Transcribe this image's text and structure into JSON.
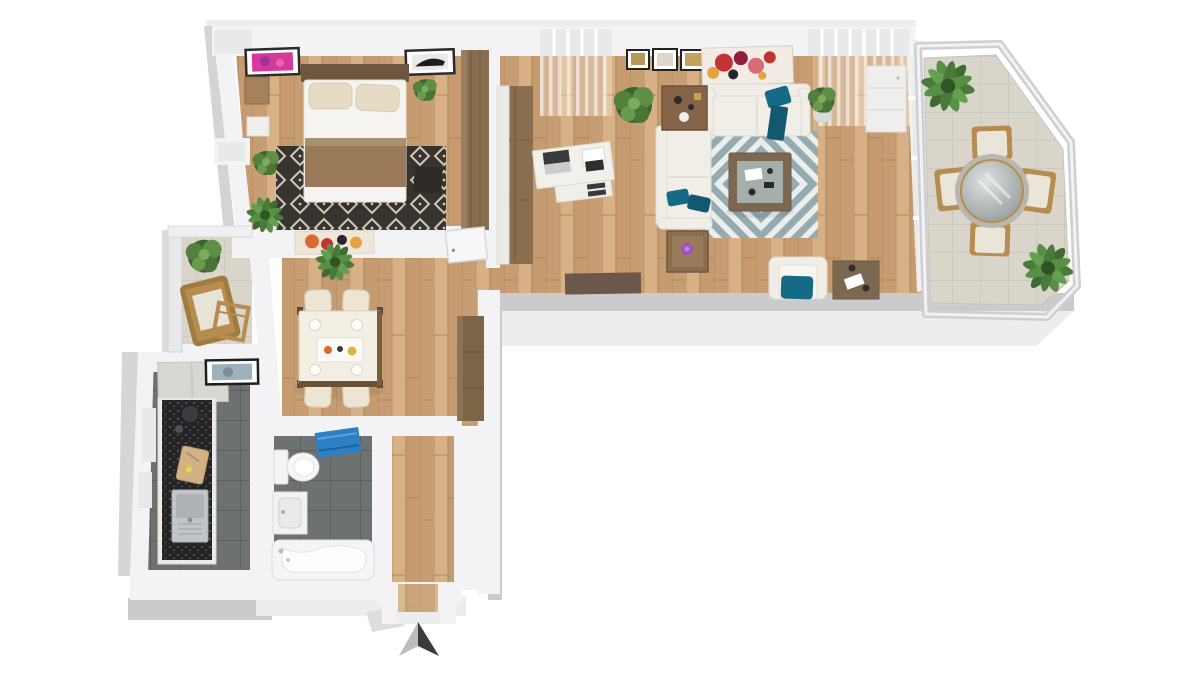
{
  "meta": {
    "description": "3D top-down rendered floor plan of an apartment with bedroom, living room, dining room, kitchen, bathroom, hallway and two balconies, north arrow at bottom",
    "view": "isometric top-down 3d render",
    "background": "white"
  },
  "colors": {
    "bg": "#ffffff",
    "wall_white": "#f3f3f5",
    "wall_shade": "#e7e7e9",
    "slab_gray": "#cbcbcd",
    "slab_light": "#ededef",
    "glass": "#e7e9eb",
    "wood_floor": "#cfa87e",
    "tile_dark": "#6d7170",
    "balcony_tile": "#d9d5cb",
    "rug_dark": "#37332f",
    "rug_cream": "#cfc8b8",
    "chevron_teal": "#93abb1",
    "chevron_white": "#eceeec",
    "accent_teal": "#156a85",
    "sofa_white": "#f1eee7",
    "wood_furniture": "#8a6e50",
    "chair_tan": "#b68d4f",
    "blanket_brown": "#9b7a5a",
    "pillow_beige": "#e6dcc6",
    "plant_green": "#53803e",
    "counter_black": "#242427",
    "towel_blue": "#2f7fc4",
    "flower_purple": "#a44fc0",
    "art_red": "#c13433",
    "art_pink": "#d6399b",
    "arrow_light": "#bdbdbf",
    "arrow_dark": "#3a3a3c"
  },
  "compass": {
    "direction": "north",
    "style": "two-tone arrow pointing up"
  },
  "rooms": [
    {
      "id": "bedroom",
      "floor": "wood",
      "furniture": [
        "double-bed",
        "dark-diamond-rug",
        "headboard",
        "nightstand",
        "white-cabinet",
        "wardrobe",
        "bench",
        "potted-plants",
        "pink-wall-art",
        "dark-wall-art",
        "window"
      ]
    },
    {
      "id": "living-room",
      "floor": "wood",
      "furniture": [
        "corner-sofa",
        "wall-sofa",
        "chevron-rug",
        "coffee-table",
        "side-table",
        "flower-table",
        "desk",
        "laptop",
        "drawer-unit",
        "armchair",
        "square-table",
        "door-mat",
        "tall-cabinet",
        "white-cabinet",
        "potted-plants",
        "three-small-frames",
        "abstract-painting",
        "windows",
        "glazed-balcony-wall"
      ]
    },
    {
      "id": "dining-room",
      "floor": "wood",
      "furniture": [
        "dining-table",
        "four-chairs",
        "table-runner",
        "plates",
        "sideboard",
        "potted-plant",
        "abstract-wall-art",
        "open-door"
      ]
    },
    {
      "id": "kitchen",
      "floor": "dark-tile",
      "furniture": [
        "l-counter",
        "granite-worktop",
        "sink",
        "cooktop-pot",
        "cutting-board",
        "tall-cabinet",
        "wall-panel",
        "windows"
      ]
    },
    {
      "id": "bathroom",
      "floor": "dark-tile",
      "furniture": [
        "bathtub",
        "toilet",
        "washbasin-vanity",
        "blue-towel"
      ]
    },
    {
      "id": "hallway",
      "floor": "wood",
      "furniture": [
        "entry-threshold"
      ]
    },
    {
      "id": "balcony-east",
      "floor": "beige-tile",
      "furniture": [
        "round-glass-table",
        "four-wooden-chairs",
        "potted-palms",
        "glass-railing"
      ]
    },
    {
      "id": "balcony-west",
      "floor": "beige-tile",
      "furniture": [
        "wooden-chair",
        "wooden-side-table",
        "potted-plant",
        "glass-railing"
      ]
    }
  ]
}
